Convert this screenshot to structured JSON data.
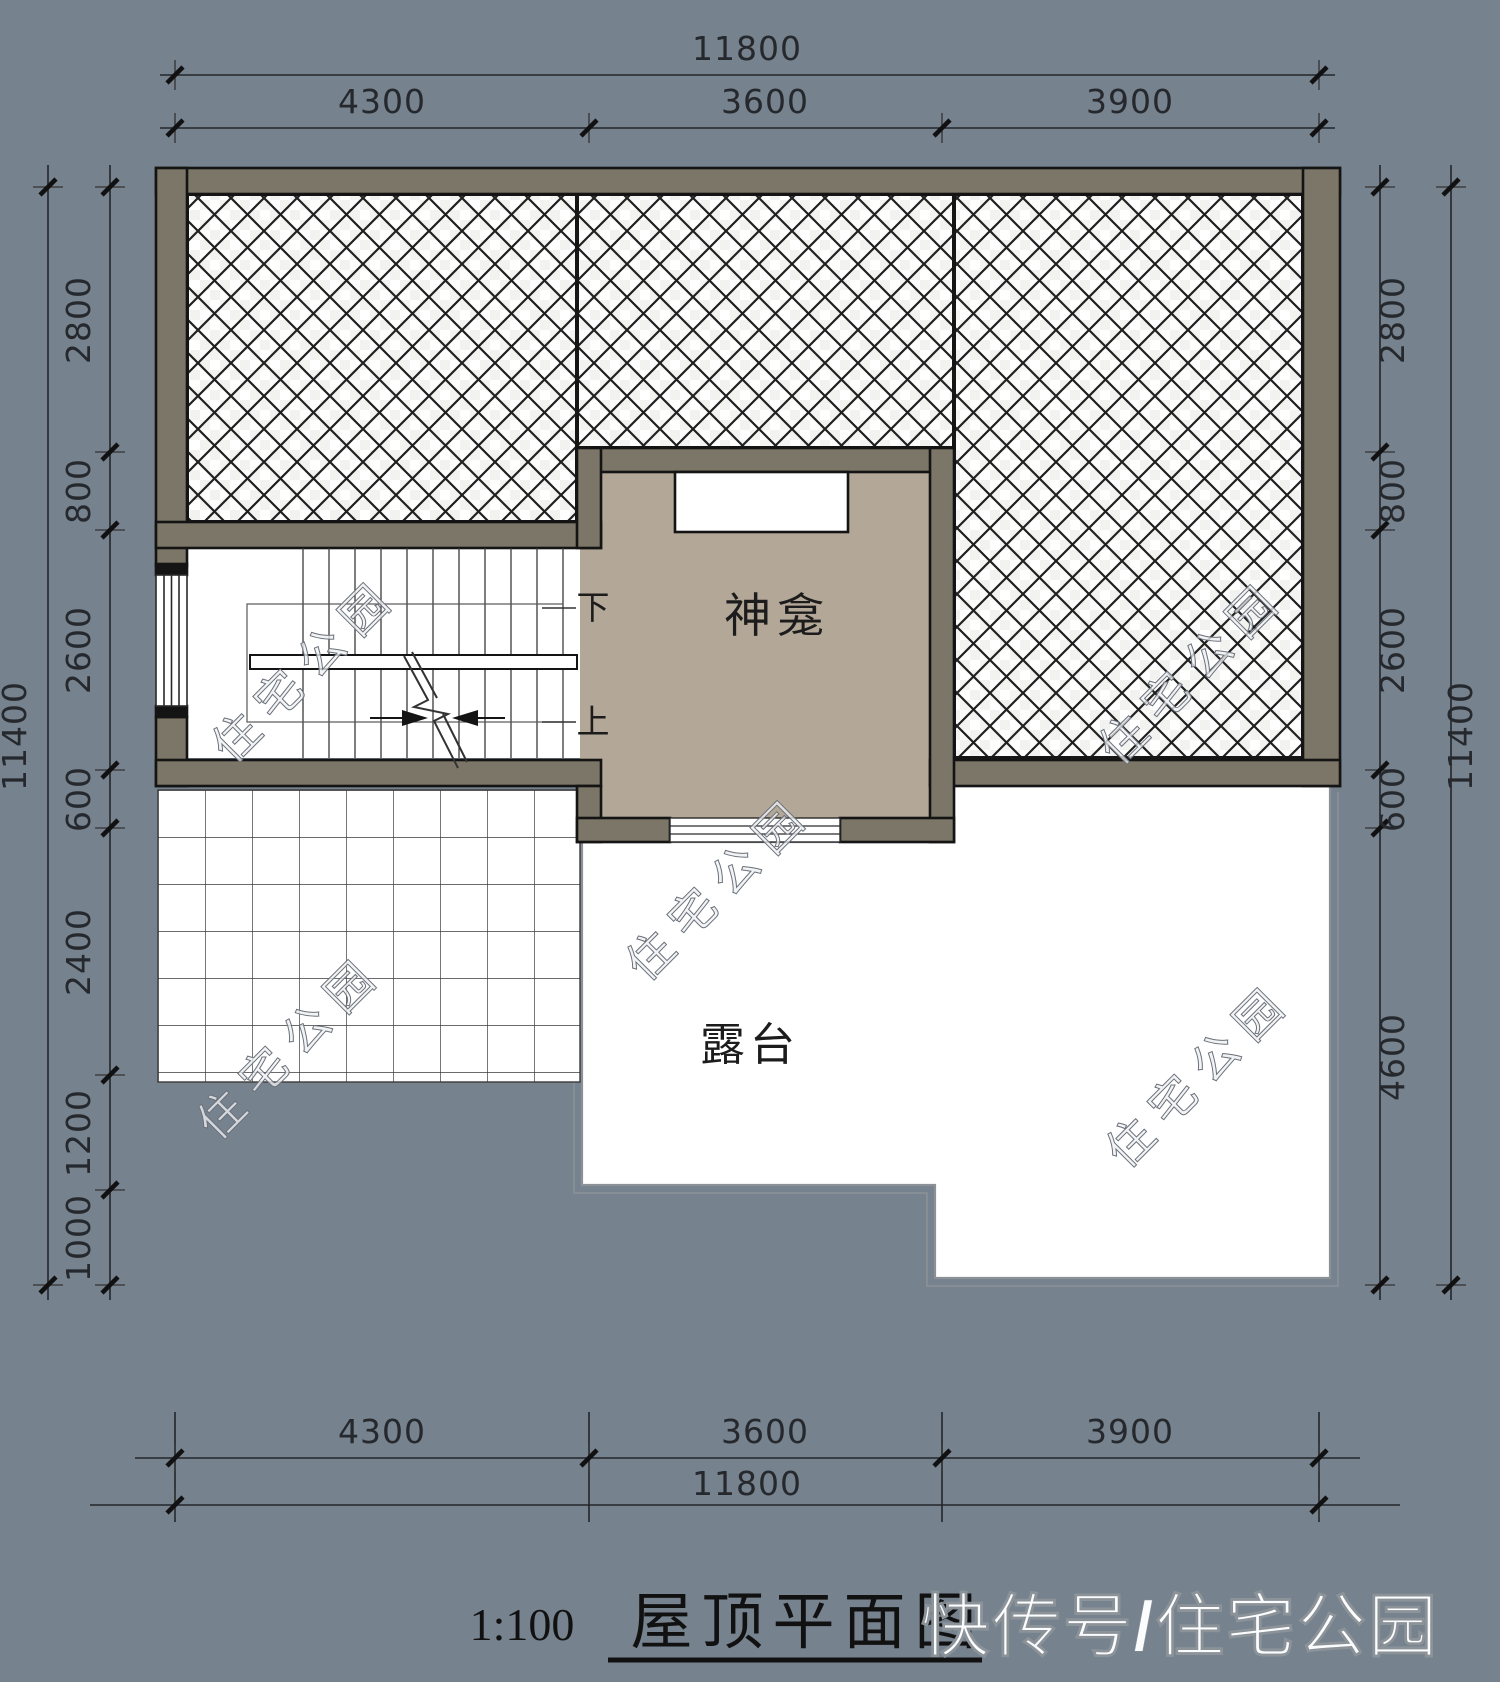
{
  "dims": {
    "top": {
      "total": "11800",
      "segments": [
        "4300",
        "3600",
        "3900"
      ]
    },
    "bottom": {
      "total": "11800",
      "segments": [
        "4300",
        "3600",
        "3900"
      ]
    },
    "left": {
      "total": "11400",
      "segments": [
        "2800",
        "800",
        "2600",
        "600",
        "2400",
        "1200",
        "1000"
      ]
    },
    "right": {
      "total": "11400",
      "segments": [
        "2800",
        "800",
        "2600",
        "600",
        "4600"
      ]
    }
  },
  "rooms": {
    "shrine": "神龛",
    "terrace": "露台"
  },
  "stair": {
    "down": "下",
    "up": "上"
  },
  "title": {
    "scale": "1:100",
    "name": "屋顶平面图"
  },
  "watermarks": {
    "diagonal": "住宅公园",
    "footer": "快传号/住宅公园"
  },
  "colors": {
    "background": "#76828E",
    "wall": "#7C7668",
    "shrine_floor": "#B3A797",
    "paper_white": "#FFFFFF",
    "line": "#1A1A1A"
  }
}
